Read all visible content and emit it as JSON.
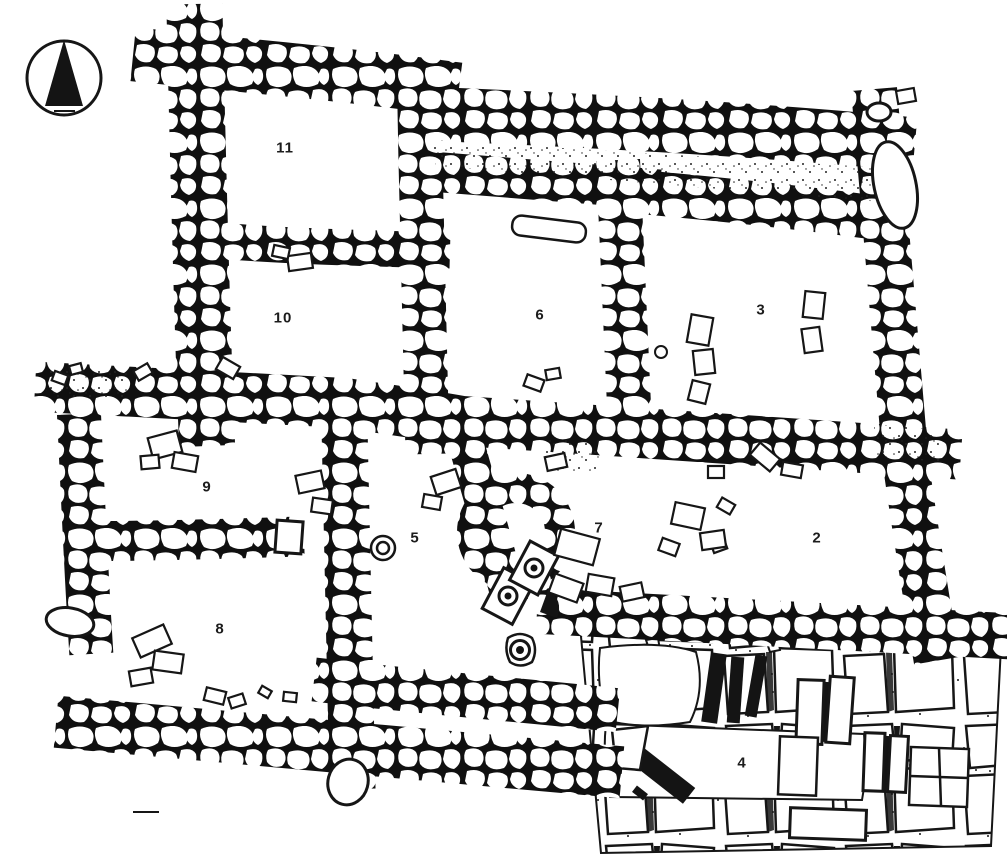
{
  "page": {
    "paper_color": "#ffffff",
    "ink_color": "#161616"
  },
  "compass": {
    "icon": "north-arrow-icon",
    "direction": "N"
  },
  "rooms": [
    {
      "number": "11",
      "x": 285,
      "y": 148
    },
    {
      "number": "10",
      "x": 283,
      "y": 318
    },
    {
      "number": "6",
      "x": 540,
      "y": 315
    },
    {
      "number": "3",
      "x": 761,
      "y": 310
    },
    {
      "number": "9",
      "x": 207,
      "y": 487
    },
    {
      "number": "5",
      "x": 415,
      "y": 538
    },
    {
      "number": "7",
      "x": 599,
      "y": 528
    },
    {
      "number": "2",
      "x": 817,
      "y": 538
    },
    {
      "number": "8",
      "x": 220,
      "y": 629
    },
    {
      "number": "4",
      "x": 742,
      "y": 763
    }
  ],
  "features": [
    {
      "name": "socket-stone",
      "x": 508,
      "y": 596
    },
    {
      "name": "socket-stone",
      "x": 534,
      "y": 568
    },
    {
      "name": "socket-stone",
      "x": 520,
      "y": 650
    }
  ]
}
